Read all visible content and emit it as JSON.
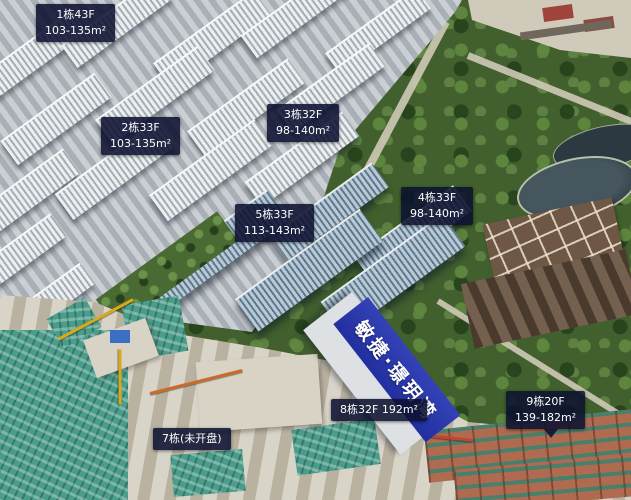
{
  "banner": {
    "text": "敏捷·璟玥湾"
  },
  "colors": {
    "label_bg": "#0c1130",
    "banner_blue": "#2b38ab"
  },
  "labels": [
    {
      "building": "1",
      "line1": "1栋43F",
      "line2": "103-135m²"
    },
    {
      "building": "2",
      "line1": "2栋33F",
      "line2": "103-135m²"
    },
    {
      "building": "3",
      "line1": "3栋32F",
      "line2": "98-140m²"
    },
    {
      "building": "4",
      "line1": "4栋33F",
      "line2": "98-140m²"
    },
    {
      "building": "5",
      "line1": "5栋33F",
      "line2": "113-143m²"
    },
    {
      "building": "8",
      "line1": "8栋32F 192m²",
      "line2": ""
    },
    {
      "building": "7",
      "line1": "7栋(未开盘)",
      "line2": ""
    },
    {
      "building": "9",
      "line1": "9栋20F",
      "line2": "139-182m²"
    }
  ]
}
